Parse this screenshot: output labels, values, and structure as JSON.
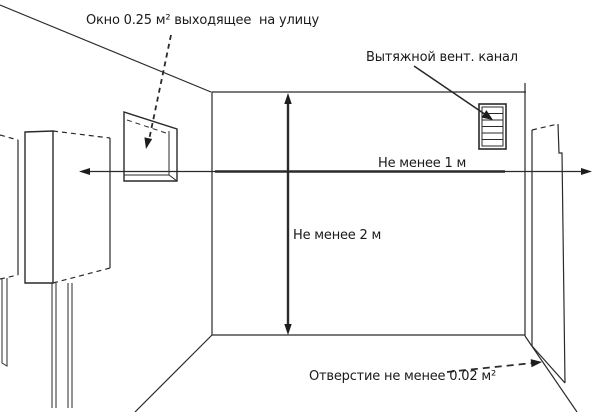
{
  "labels": {
    "window": "Окно 0.25 м² выходящее  на улицу",
    "vent_channel": "Вытяжной вент. канал",
    "min_distance_width": "Не менее 1 м",
    "min_distance_height": "Не менее 2 м",
    "opening": "Отверстие не менее 0.02 м²"
  },
  "icons": {
    "vent_grille": "louvered-grille-icon",
    "boiler": "wall-boiler-icon",
    "window_frame": "window-frame-icon",
    "door": "door-icon"
  },
  "colors": {
    "background": "#ffffff",
    "line": "#2a2a2a",
    "text": "#1a1a1a"
  }
}
